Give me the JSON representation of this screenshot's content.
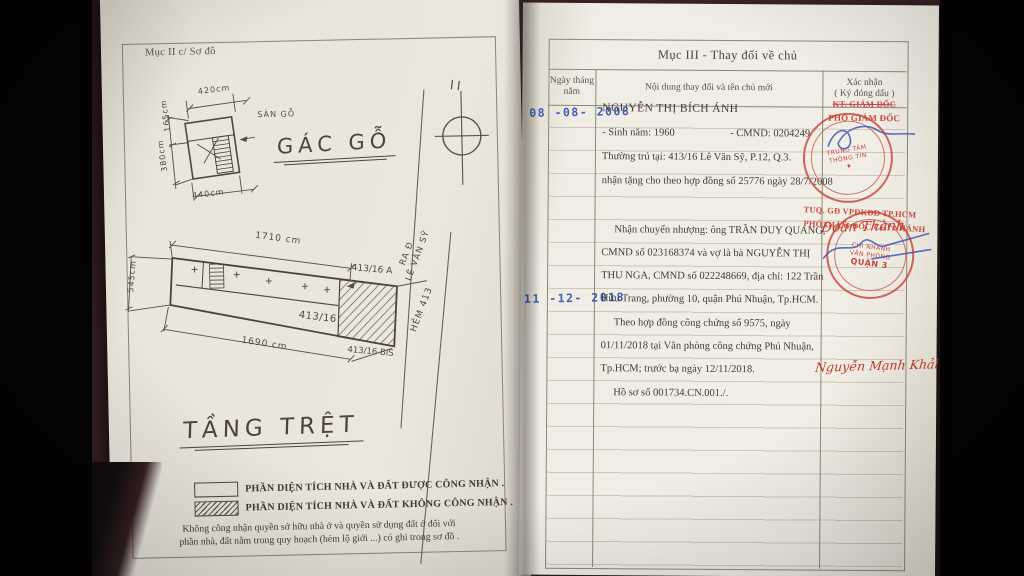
{
  "left_page": {
    "section_header": "Mục II c/ Sơ đồ",
    "attic": {
      "title": "GÁC GỖ",
      "dim_top": "420cm",
      "dim_left_upper": "165cm",
      "dim_left_total": "380cm",
      "dim_bottom": "440cm",
      "material_note": "SÀN\nGỖ"
    },
    "compass_mark": "II",
    "ground": {
      "title": "TẦNG TRỆT",
      "dim_top": "1710 cm",
      "dim_left": "545cm",
      "dim_bottom": "1690 cm",
      "lot_a": "413/16 A",
      "lot_main": "413/16",
      "lot_bis": "413/16 BIS",
      "street_exit": "RA Đ.\nLÊ VĂN SỸ",
      "alley": "HẺM 413"
    },
    "legend": {
      "recognized": "PHẦN DIỆN TÍCH NHÀ VÀ ĐẤT ĐƯỢC CÔNG NHẬN .",
      "not_recognized": "PHẦN DIỆN TÍCH NHÀ VÀ ĐẤT KHÔNG CÔNG NHẬN .",
      "note_line1": "Không công nhận quyền sở hữu nhà ở và quyền sử dụng đất ở đối với",
      "note_line2": "phần nhà, đất nằm trong quy hoạch (hẻm lộ giới ...) có ghi trong sơ đồ ."
    }
  },
  "right_page": {
    "section_title": "Mục III - Thay đổi về chủ",
    "columns": {
      "date": "Ngày tháng\nnăm",
      "content": "Nội dung thay đổi và tên chủ mới",
      "confirm": "Xác nhận\n( Ký đóng dấu )"
    },
    "entries": [
      {
        "date": "08 -08- 2008",
        "owner_name": "NGUYỄN THỊ BÍCH ÁNH",
        "birth": "- Sinh năm: 1960",
        "id_number": "- CMND: 0204249",
        "line_address": "Thường trú tại: 413/16 Lê Văn Sỹ, P.12, Q.3.",
        "line_transfer": "nhận tặng cho theo hợp đồng số 25776 ngày 28/7/2008",
        "approval": {
          "title_1": "KT. GIÁM ĐỐC",
          "title_2": "PHÓ GIÁM ĐỐC",
          "stamp": [
            "TRUNG TÂM",
            "THÔNG TIN",
            "★"
          ],
          "signer": "Đoàn Thành"
        }
      },
      {
        "date": "11 -12- 2018",
        "lines": [
          "Nhận chuyển nhượng: ông TRẦN DUY QUANG,",
          "CMND số 023168374 và vợ là bà NGUYỄN THỊ",
          "THU NGA, CMND số 022248669, địa chỉ: 122 Trần",
          "Hữu Trang, phường 10, quận Phú Nhuận, Tp.HCM.",
          "Theo hợp đồng công chứng số 9575, ngày",
          "01/11/2018 tại Văn phòng công chứng Phú Nhuận,",
          "Tp.HCM; trước bạ ngày 12/11/2018.",
          "Hồ sơ số 001734.CN.001./."
        ],
        "approval": {
          "title_1": "TUQ. GĐ VPĐKĐĐ TP.HCM",
          "title_2": "PHÓ GIÁM ĐỐC CHI NHÁNH",
          "stamp": [
            "CHI NHÁNH",
            "VĂN PHÒNG",
            "QUẬN 3"
          ],
          "signer": "Nguyễn Mạnh Khải"
        }
      }
    ]
  },
  "colors": {
    "background": "#050304",
    "table_surface": "#3d2427",
    "paper_left": "#eae6db",
    "paper_right": "#f0ede4",
    "ink": "#413c35",
    "drawing_ink": "#50493f",
    "stamp_blue": "#3350b4",
    "stamp_red": "#c43c30"
  }
}
